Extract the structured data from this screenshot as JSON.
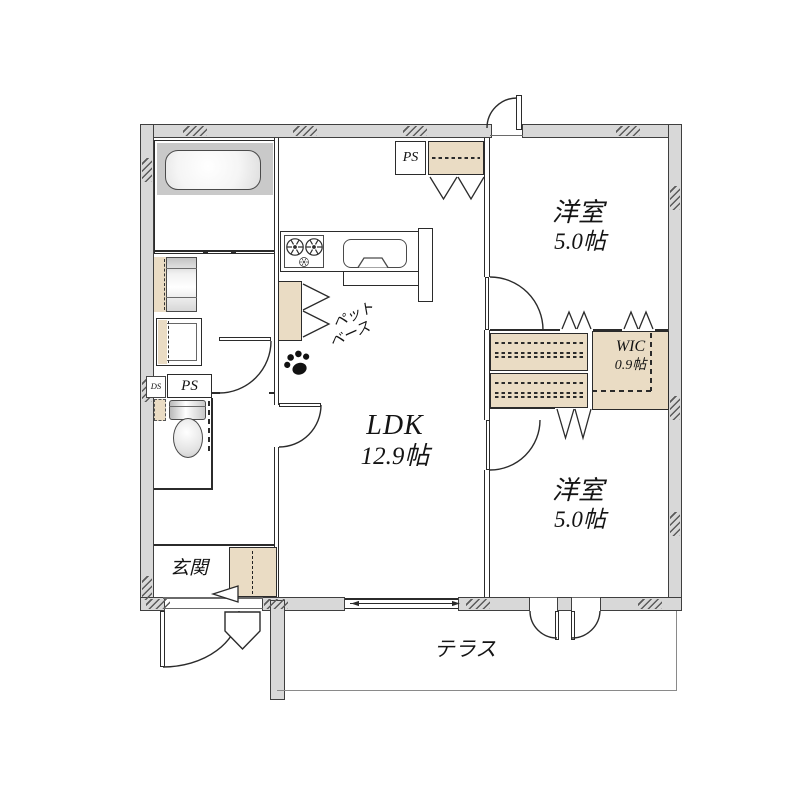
{
  "plan": {
    "type": "floor_plan",
    "rooms": {
      "ldk": {
        "name": "LDK",
        "size": "12.9帖"
      },
      "bedroom_top": {
        "name": "洋室",
        "size": "5.0帖"
      },
      "bedroom_bottom": {
        "name": "洋室",
        "size": "5.0帖"
      },
      "wic": {
        "name": "WIC",
        "size": "0.9帖"
      },
      "entrance": {
        "name": "玄関"
      },
      "terrace": {
        "name": "テラス"
      }
    },
    "annotations": {
      "pet_base_line1": "ペット",
      "pet_base_line2": "ベース",
      "ps_top": "PS",
      "ps_toilet": "PS",
      "ds": "DS"
    },
    "colors": {
      "wall_fill": "#d8d8d8",
      "wall_edge": "#3f3f3f",
      "line": "#2b2b2b",
      "closet_fill": "#eadcc4",
      "tub_deck": "#c9c9c9",
      "terrace_line": "#8a8a8a",
      "background": "#ffffff"
    }
  }
}
